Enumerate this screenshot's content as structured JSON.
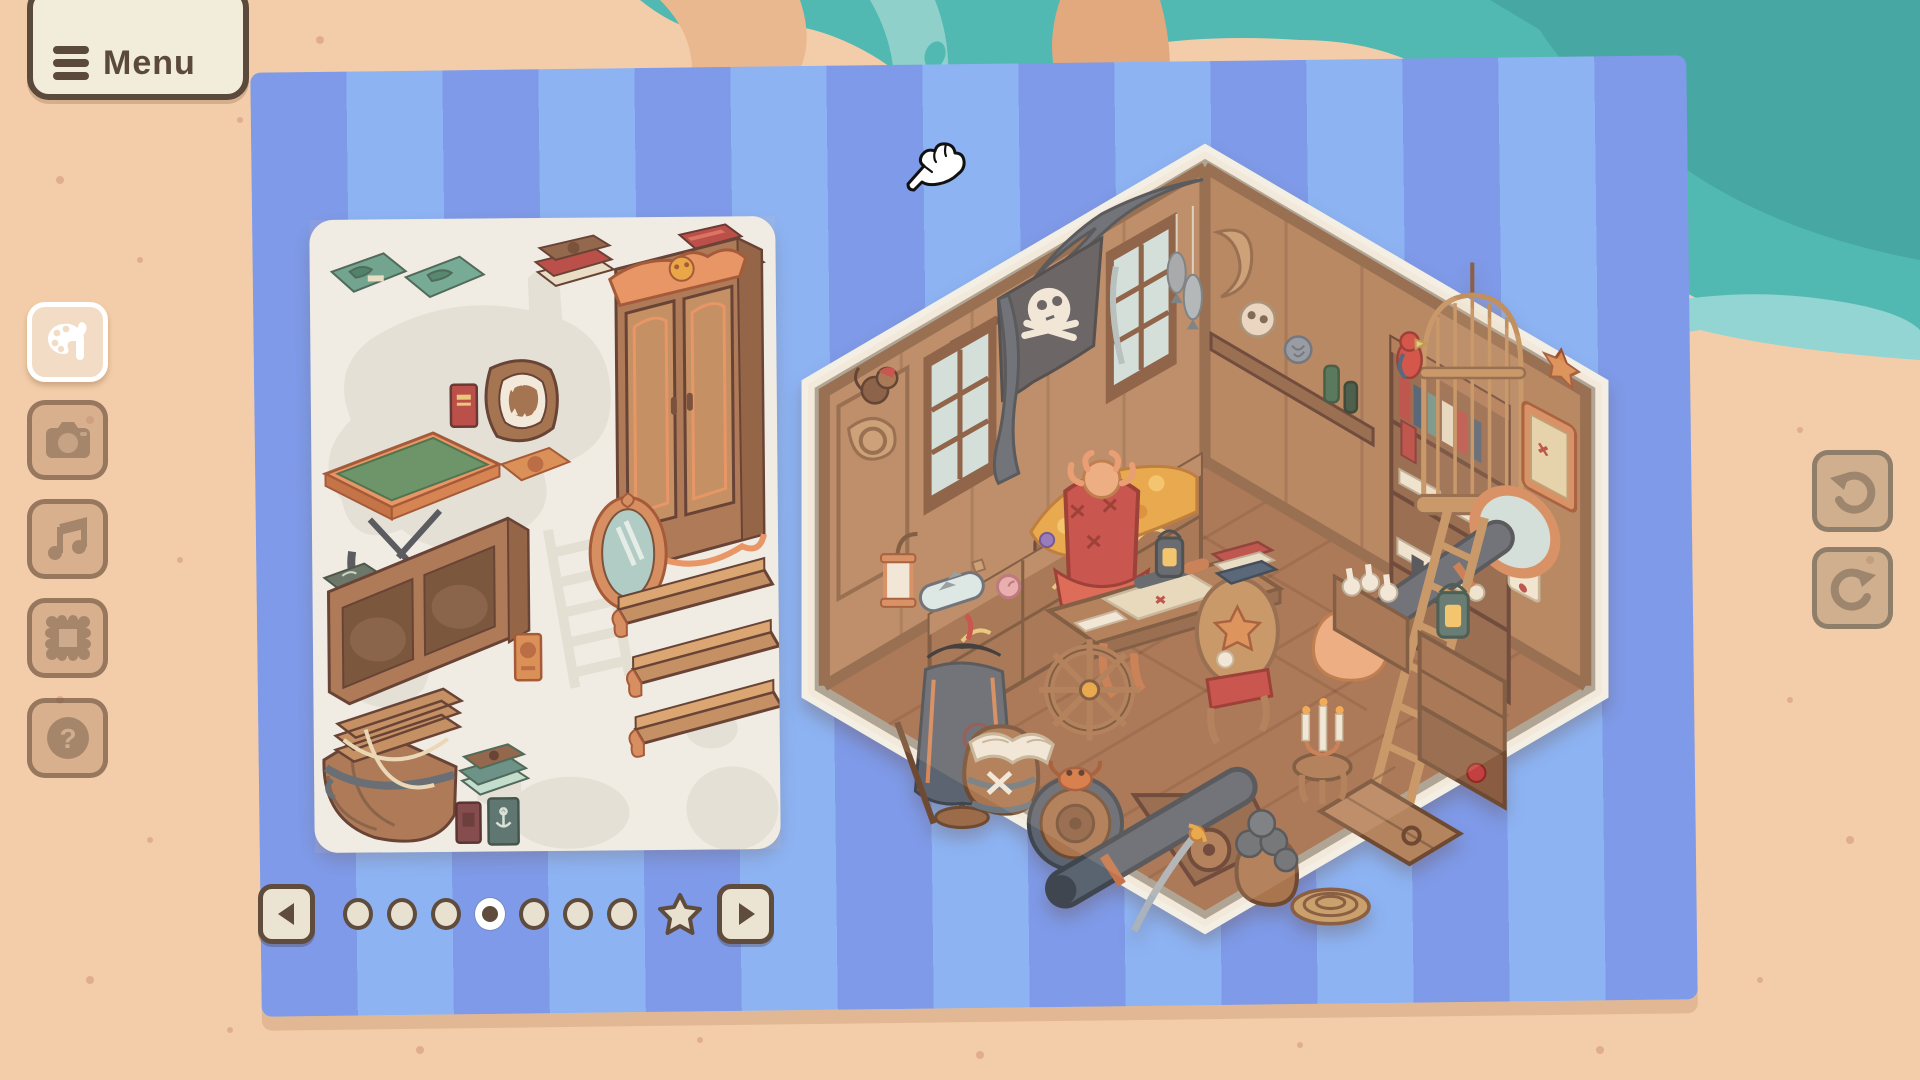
{
  "menu_button": {
    "label": "Menu",
    "icon": "hamburger-icon"
  },
  "sidebar": {
    "buttons": [
      {
        "id": "decorate",
        "icon": "palette-brush-icon",
        "active": true
      },
      {
        "id": "photo",
        "icon": "camera-icon",
        "active": false
      },
      {
        "id": "music",
        "icon": "music-note-icon",
        "active": false
      },
      {
        "id": "frame",
        "icon": "picture-frame-icon",
        "active": false
      },
      {
        "id": "help",
        "icon": "question-mark-icon",
        "active": false
      }
    ]
  },
  "history_controls": {
    "undo": {
      "icon": "undo-arrow-icon",
      "enabled": false
    },
    "redo": {
      "icon": "redo-arrow-icon",
      "enabled": false
    }
  },
  "pagination": {
    "prev_icon": "left-triangle-icon",
    "next_icon": "right-triangle-icon",
    "dots_total": 7,
    "active_index": 3,
    "star_page": {
      "present": true,
      "icon": "star-icon",
      "position": "after-dots"
    }
  },
  "sticker_sheet": {
    "stickers": [
      "flat-teal-map-book",
      "flat-teal-map-book-2",
      "brown-red-book-stack",
      "red-book-flat",
      "small-brown-book-flat",
      "ornate-wardrobe-with-skull-carving",
      "shark-jaw-plaque",
      "red-book-standing",
      "green-felt-map-table",
      "orange-book-flat",
      "ornate-oval-mirror",
      "flat-dark-book",
      "low-open-bookcase",
      "orange-book-standing",
      "wall-shelf-1",
      "wall-shelf-2",
      "wall-shelf-3",
      "boat-basket-bed",
      "teal-book-stack",
      "dark-red-book-standing",
      "teal-anchor-book-standing"
    ],
    "used_silhouettes": [
      "map-blob",
      "tall-mast",
      "ladder",
      "hexagon",
      "rock-1",
      "rock-2",
      "curl"
    ]
  },
  "room": {
    "shape": "isometric-hexagon",
    "theme": "pirate captain's cabin",
    "items": [
      "jolly-roger-flag",
      "gray-drapes",
      "musket",
      "window-left-1",
      "window-left-2",
      "monkey-on-scroll-pillar",
      "wall-clock",
      "treasure-dresser",
      "gold-treasure-pile",
      "ship-in-bottle",
      "pink-conch-shell",
      "wall-lantern",
      "pirate-coat-stand",
      "octopus-red-armchair",
      "map-desk",
      "telescope",
      "ship-wheel",
      "starfish-chair",
      "x-barrel-with-open-book",
      "side-barrel-with-crab",
      "floor-cannon",
      "cannonball-stack",
      "cutlass-sword",
      "rope-coil",
      "floor-hatch",
      "stool-with-candelabra",
      "scroll-crate",
      "tall-bookshelf",
      "skull-on-shelf",
      "green-bottles",
      "hanging-fish",
      "birdcage",
      "red-parrot",
      "framed-map",
      "starfish-on-wall",
      "porthole-cannon",
      "wooden-ladder",
      "crate-stack-with-lantern",
      "wall-scroll-note"
    ]
  },
  "cursor": {
    "style": "white-glove-hand-pointer",
    "x": 905,
    "y": 143
  },
  "colors": {
    "sand": "#f3cda9",
    "sand_speckle": "#d09678",
    "water": "#52b8b2",
    "water_deep": "#47a7a2",
    "water_foam": "#93d5d2",
    "mat_stripe_dark": "#7e9ae8",
    "mat_stripe_light": "#8db3f3",
    "chrome_cream": "#f2ecdb",
    "chrome_brown": "#5b4a3b",
    "sheet_white": "#f1f0ea",
    "ghost_gray": "#e3e3dc",
    "wood_wall": "#b4845f",
    "wood_floor": "#a06b4a",
    "accent_red": "#c2403f",
    "accent_orange": "#e89060",
    "cannon_slate": "#5a6470"
  }
}
